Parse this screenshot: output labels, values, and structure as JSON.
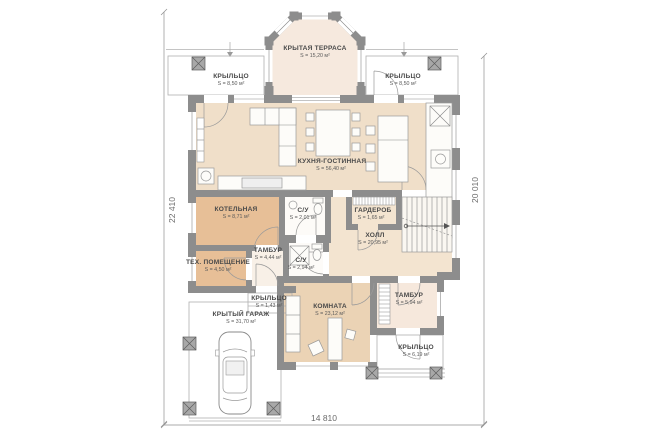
{
  "plan_title": "floor-plan-first-floor",
  "colors": {
    "wall": "#8d8d8d",
    "room_light_beige": "#f0dfc9",
    "room_dark_tan": "#e7bf97",
    "room_warm_tan": "#ebd3b5",
    "room_pale_pink": "#f6e9de",
    "line_gray": "#9a9a9a"
  },
  "dimensions": {
    "left": "22 410",
    "right": "20 010",
    "bottom": "14 810"
  },
  "rooms": [
    {
      "id": "covered-terrace",
      "name": "КРЫТАЯ ТЕРРАСА",
      "area": "S = 15,20 м²"
    },
    {
      "id": "porch-top-left",
      "name": "КРЫЛЬЦО",
      "area": "S = 8,50 м²"
    },
    {
      "id": "porch-top-right",
      "name": "КРЫЛЬЦО",
      "area": "S = 8,50 м²"
    },
    {
      "id": "kitchen-living",
      "name": "КУХНЯ-ГОСТИННАЯ",
      "area": "S = 56,40 м²"
    },
    {
      "id": "boiler-room",
      "name": "КОТЕЛЬНАЯ",
      "area": "S = 8,71 м²"
    },
    {
      "id": "wc-1",
      "name": "С/У",
      "area": "S = 2,01 м²"
    },
    {
      "id": "wardrobe",
      "name": "ГАРДЕРОБ",
      "area": "S = 1,65 м²"
    },
    {
      "id": "hall",
      "name": "ХОЛЛ",
      "area": "S = 20,95 м²"
    },
    {
      "id": "vestibule-1",
      "name": "ТАМБУР",
      "area": "S = 4,44 м²"
    },
    {
      "id": "tech-room",
      "name": "ТЕХ. ПОМЕЩЕНИЕ",
      "area": "S = 4,50 м²"
    },
    {
      "id": "wc-2",
      "name": "С/У",
      "area": "S = 2,94 м²"
    },
    {
      "id": "porch-small",
      "name": "КРЫЛЬЦО",
      "area": "S = 1,43 м²"
    },
    {
      "id": "room",
      "name": "КОМНАТА",
      "area": "S = 23,12 м²"
    },
    {
      "id": "vestibule-2",
      "name": "ТАМБУР",
      "area": "S = 5,94 м²"
    },
    {
      "id": "covered-garage",
      "name": "КРЫТЫЙ ГАРАЖ",
      "area": "S = 31,70 м²"
    },
    {
      "id": "porch-bottom-right",
      "name": "КРЫЛЬЦО",
      "area": "S = 6,19 м²"
    }
  ]
}
